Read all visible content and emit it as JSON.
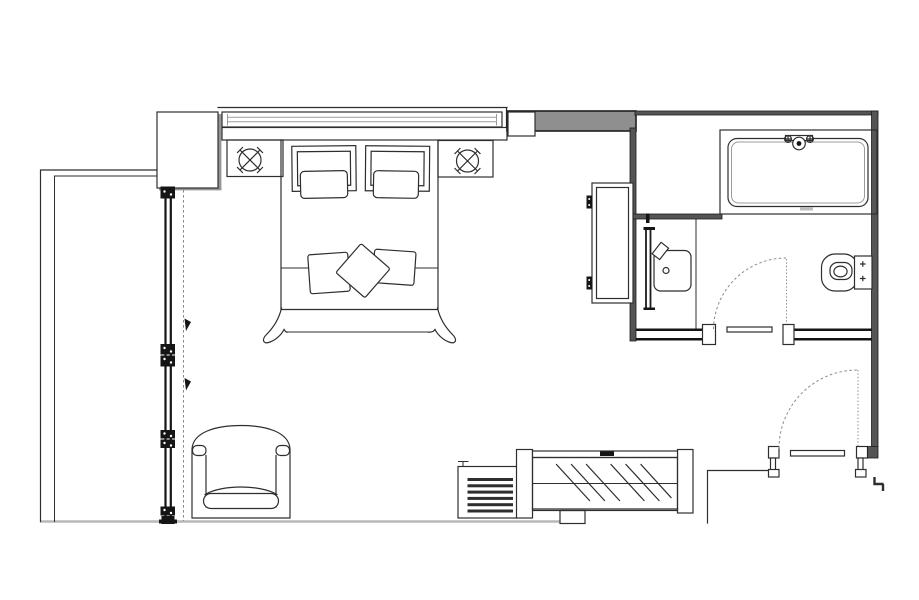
{
  "document": {
    "type": "architectural-floor-plan",
    "title": "Hotel guest room floor plan — bedroom, bathroom and entry",
    "background": "#ffffff"
  },
  "colors": {
    "line": "#2e2e2e",
    "wall_fill": "#555555",
    "wall_band": "#8f8f8f",
    "shadow": "#969696",
    "floor_line": "#b8b8b8",
    "dashed": "#8a8a8a",
    "glazing": "#9b9b9b"
  },
  "elements": {
    "exterior_wall": {
      "label": "Exterior wall (left)"
    },
    "window_wall": {
      "label": "Window wall with mullion joints and sliding-panel guide"
    },
    "wardrobe": {
      "label": "Wardrobe cabinet at window corner"
    },
    "curtain_box": {
      "label": "Curtain box / glazing band behind headboard"
    },
    "headboard_shelf": {
      "label": "Headboard console with bedside niches"
    },
    "ceiling_light_left": {
      "label": "Ceiling light symbol (circle with cross)"
    },
    "ceiling_light_right": {
      "label": "Ceiling light symbol (circle with cross)"
    },
    "bed": {
      "label": "Double bed with headboard cushions, two pillows and bedspread"
    },
    "decorative_pillows": {
      "label": "Three decorative throw pillows"
    },
    "armchair": {
      "label": "Lounge armchair"
    },
    "floor_grille": {
      "label": "Floor convector grille"
    },
    "console": {
      "label": "Glass-top console / minibar unit"
    },
    "tall_cabinet": {
      "label": "Tall hinged storage cabinet"
    },
    "partition_wall": {
      "label": "Bedroom–bathroom partition wall"
    },
    "bathtub": {
      "label": "Bathtub with wall-mounted mixer tap"
    },
    "washbasin": {
      "label": "Washbasin vanity with mirror panel"
    },
    "toilet": {
      "label": "Toilet with cistern"
    },
    "bathroom_door": {
      "label": "Bathroom swing door (dashed swing arc)"
    },
    "entry_door": {
      "label": "Room entry swing door (dashed swing arc)"
    },
    "entry_wall": {
      "label": "Entry corridor wall"
    }
  }
}
